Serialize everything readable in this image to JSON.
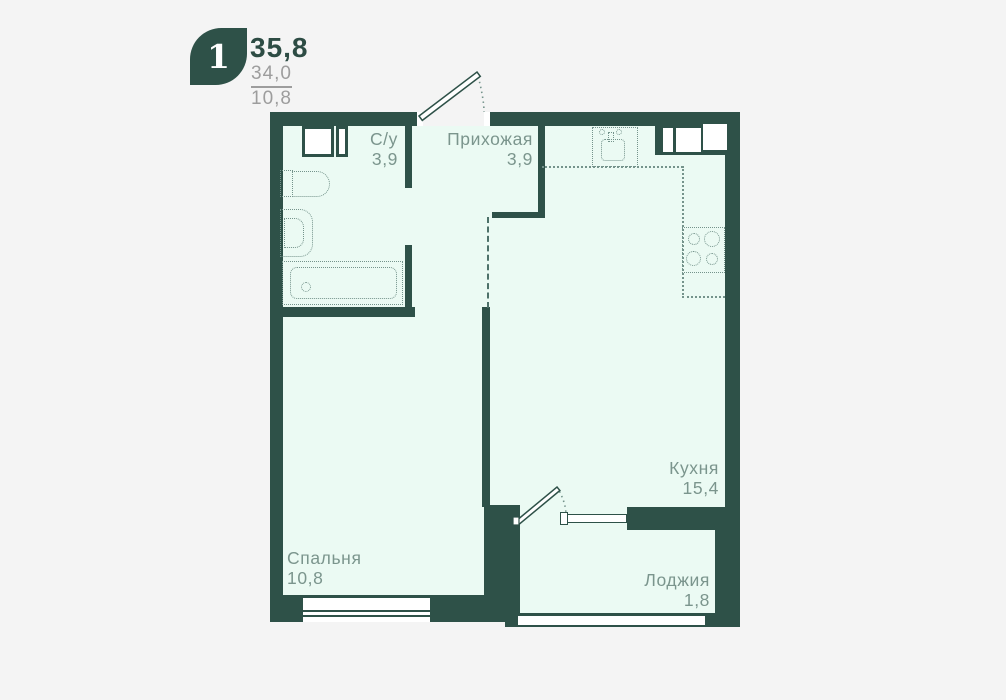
{
  "legend": {
    "room_count": "1",
    "total_area": "35,8",
    "secondary_area": "34,0",
    "tertiary_area": "10,8"
  },
  "rooms": {
    "bathroom": {
      "name": "С/у",
      "area": "3,9"
    },
    "hallway": {
      "name": "Прихожая",
      "area": "3,9"
    },
    "kitchen": {
      "name": "Кухня",
      "area": "15,4"
    },
    "bedroom": {
      "name": "Спальня",
      "area": "10,8"
    },
    "loggia": {
      "name": "Лоджия",
      "area": "1,8"
    }
  },
  "colors": {
    "wall": "#2e5148",
    "floor": "#ebfaf3",
    "label": "#7b958d",
    "title": "#2d4c44",
    "secondary": "#9d9d9d",
    "fixture": "#74938b",
    "dashed": "#4d7169",
    "background": "#f4f4f4"
  }
}
